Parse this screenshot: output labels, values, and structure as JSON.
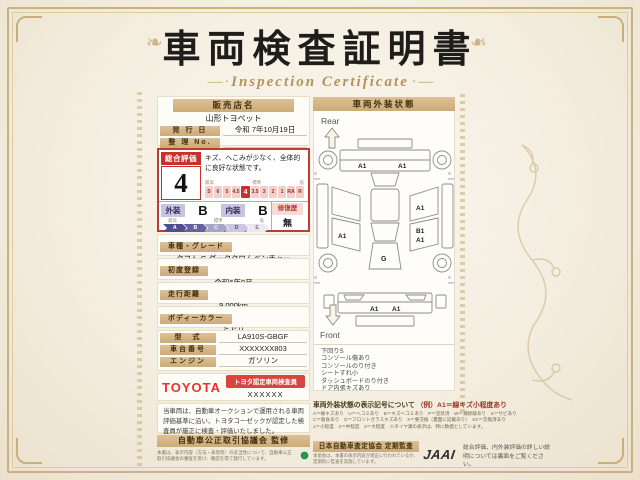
{
  "title": "車両検査証明書",
  "subtitle": "Inspection Certificate",
  "dealer": {
    "label": "販売店名",
    "name": "山形トヨペット"
  },
  "issue_date": {
    "label": "発 行 日",
    "value": "令和 7年10月19日"
  },
  "ref_no": {
    "label": "整 理 No.",
    "value": ""
  },
  "evaluation": {
    "label": "総合評価",
    "score": "4",
    "comment": "キズ、へこみが少なく、全体的に良好な状態です。",
    "scale_high": "最高",
    "scale_mid": "標準",
    "scale_low": "低",
    "scale": [
      "S",
      "6",
      "5",
      "4.5",
      "4",
      "3.5",
      "3",
      "2",
      "1",
      "RA",
      "R"
    ],
    "selected": "4",
    "exterior_label": "外装",
    "exterior_grade": "B",
    "interior_label": "内装",
    "interior_grade": "B",
    "repair_label": "修復歴",
    "repair_value": "無",
    "grade_scale": [
      "A",
      "B",
      "C",
      "D",
      "E"
    ]
  },
  "fields": [
    {
      "label": "車種・グレード",
      "value": "タフト G ダーククロムベンチャー"
    },
    {
      "label": "初度登録",
      "value": "令和6年9月"
    },
    {
      "label": "走行距離",
      "value": "9,000km"
    },
    {
      "label": "ボディーカラー",
      "value": "ミドリ"
    },
    {
      "label": "型　式",
      "value": "LA910S-GBGF"
    },
    {
      "label": "車台番号",
      "value": "XXXXXXX803"
    },
    {
      "label": "エンジン",
      "value": "ガソリン"
    }
  ],
  "inspector": {
    "brand": "TOYOTA",
    "badge": "トヨタ認定車両検査員",
    "code": "XXXXXX"
  },
  "disclaimer": "当車両は、自動車オークションで運用される車両評価基準に沿い、トヨタコーゼックが認定した検査員が厳正に検査・評価いたしました。",
  "fair_trade": {
    "title": "自動車公正取引協議会 監修",
    "note": "本書は、表示内容（方法・表現等）の妥当性について、自動車公正取引協議会の審査を受け、確認を得て発行しています。"
  },
  "exterior_panel": {
    "title": "車両外装状態",
    "rear_label": "Rear",
    "front_label": "Front",
    "marks": {
      "rear_left": "A1",
      "rear_right": "A1",
      "left_door": "A1",
      "right_top": "A1",
      "right_mid_1": "B1",
      "right_mid_2": "A1",
      "hood": "G",
      "front_left": "A1",
      "front_right": "A1",
      "tread": "S",
      "tread_unit": "mm"
    },
    "notes": [
      "下回りS",
      "コンソール傷あり",
      "コンソールのり付き",
      "シートすれ小",
      "ダッシュボードのり付き",
      "ドア内張キズあり"
    ]
  },
  "legend": {
    "title": "車両外装状態の表示記号について",
    "example": "（例）A1＝線キズ小程度あり",
    "lines": [
      "A＝線キズあり　U＝ヘコミあり　B＝キズヘコミあり　P＝塗装済　W＝補修跡あり　S＝サビあり",
      "C＝腐食あり　G＝フロントガラスキズあり　X＝要交換（裏面に記載あり）　XX＝交換済あり",
      "1＝小程度　2＝中程度　3＝大程度　※タイヤ溝の表示は、特に数値としています。"
    ]
  },
  "audit": {
    "title": "日本自動車査定協会 定期監査",
    "note": "本協会は、本書の表示内容が適正に行われているか、定期的に監査を実施しています。",
    "logo": "JAAI"
  },
  "back_note": "総合評価、内外装評価の詳しい説明については裏面をご覧ください。"
}
